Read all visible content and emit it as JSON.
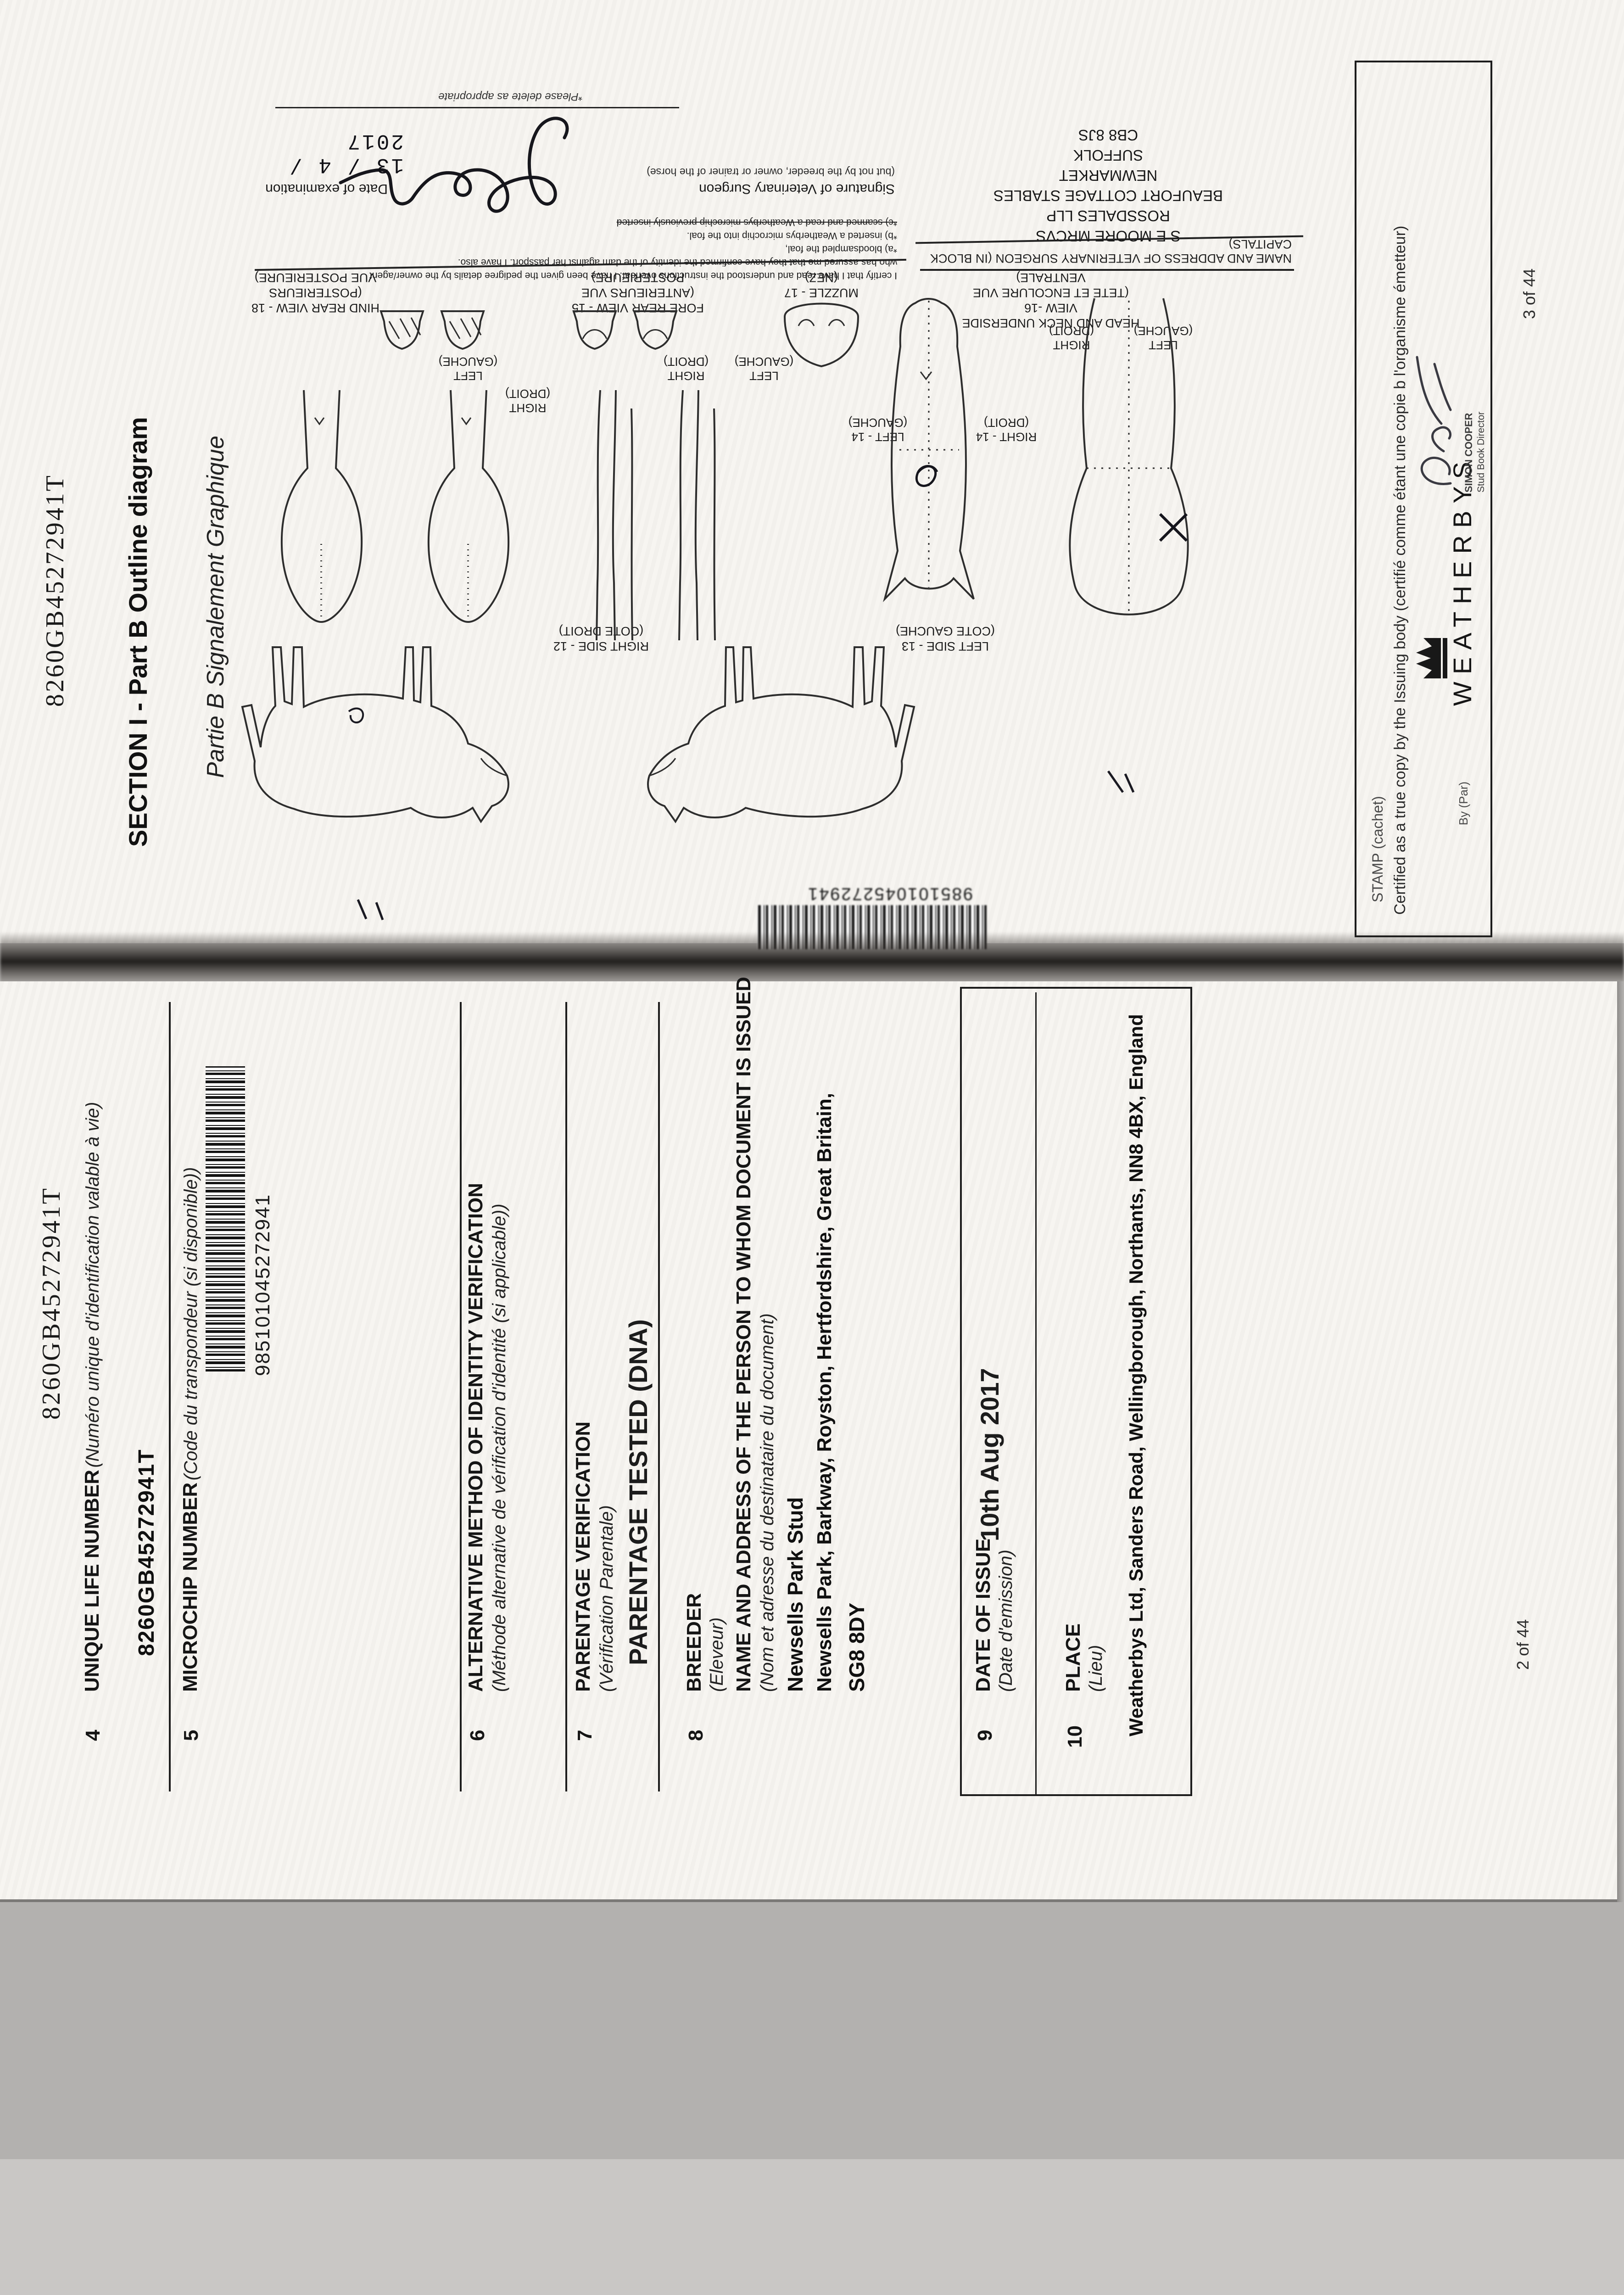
{
  "top_page": {
    "id_number": "8260GB45272941T",
    "section_title": "SECTION I - Part B Outline diagram",
    "section_subtitle": "Partie B Signalement Graphique",
    "certification": {
      "line1": "I certify that I have read and understood the instructions overleaf. I have been given the pedigree details by the owner/agent",
      "line2": "who has assured me that they have confirmed the identity of the dam against her passport. I have also.",
      "item_a": "*a) bloodsampled the foal,",
      "item_b": "*b) inserted a Weatherbys microchip into the foal.",
      "item_c": "*c) scanned and read a Weatherbys microchip previously inserted",
      "signature_label": "Signature of Veterinary Surgeon",
      "signature_note": "(but not by the breeder, owner or trainer of the horse)",
      "delete_note": "*Please delete as appropriate",
      "date_label": "Date of examination",
      "date_value": "13 / 4 / 2017"
    },
    "vet_block": {
      "heading": "NAME AND ADDRESS OF VETERINARY SURGEON (IN BLOCK CAPITALS)",
      "line1": "S E MOORE MRCVS",
      "line2": "ROSSDALES LLP",
      "line3": "BEAUFORT COTTAGE STABLES",
      "line4": "NEWMARKET",
      "line5": "SUFFOLK",
      "line6": "CB8 8JS"
    },
    "diagram_labels": {
      "hind_line1": "HIND REAR VIEW - 18 (POSTERIEURS",
      "hind_line2": "VUE POSTERIEURE)",
      "fore_line1": "FORE REAR VIEW - 15",
      "fore_line2": "(ANTERIEURS VUE POSTERIEURE)",
      "muzzle_line1": "MUZZLE - 17",
      "muzzle_line2": "(NEZ)",
      "head_line1": "HEAD AND NECK UNDERSIDE VIEW -16",
      "head_line2": "(TETE ET ENCOLURE VUE VENTRALE)",
      "right_droit": "RIGHT",
      "right_droit_fr": "(DROIT)",
      "left_gauche": "LEFT",
      "left_gauche_fr": "(GAUCHE)",
      "left14": "LEFT - 14",
      "left14_fr": "(GAUCHE)",
      "right14": "RIGHT - 14",
      "right14_fr": "(DROIT)",
      "right_side_line1": "RIGHT SIDE - 12",
      "right_side_line2": "(COTE DROIT)",
      "left_side_line1": "LEFT SIDE - 13",
      "left_side_line2": "(COTE GAUCHE)"
    },
    "barcode_number": "985101045272941",
    "stamp_box": {
      "label": "STAMP (cachet)",
      "certified_line": "Certified as a true copy by the Issuing body (certifié comme étant une copie b l'organisme émetteur)",
      "by_label": "By (Par)",
      "brand": "WEATHERBYS",
      "signatory_name": "SIMON COOPER",
      "signatory_title": "Stud Book Director"
    },
    "page_number": "3 of 44"
  },
  "bottom_page": {
    "id_number": "8260GB45272941T",
    "fields": [
      {
        "num": "4",
        "label": "UNIQUE LIFE NUMBER",
        "label_fr": "(Numéro unique d'identification valable à vie)",
        "value": "8260GB45272941T"
      },
      {
        "num": "5",
        "label": "MICROCHIP NUMBER",
        "label_fr": "(Code du transpondeur (si disponible))",
        "value": "985101045272941"
      },
      {
        "num": "6",
        "label": "ALTERNATIVE METHOD OF IDENTITY VERIFICATION",
        "label_fr": "(Méthode alternative de vérification d'identité (si applicable))"
      },
      {
        "num": "7",
        "label": "PARENTAGE VERIFICATION",
        "label_fr": "(Vérification Parentale)",
        "value": "PARENTAGE TESTED (DNA)"
      },
      {
        "num": "8",
        "label": "BREEDER",
        "label_fr": "(Eleveur)",
        "label2": "NAME AND ADDRESS OF THE PERSON TO WHOM DOCUMENT IS ISSUED",
        "label2_fr": "(Nom et adresse du destinataire du document)",
        "value_line1": "Newsells Park Stud",
        "value_line2": "Newsells Park, Barkway, Royston, Hertfordshire, Great Britain,",
        "value_line3": "SG8 8DY"
      },
      {
        "num": "9",
        "label": "DATE OF ISSUE",
        "label_fr": "(Date d'emission)",
        "value": "10th Aug 2017"
      },
      {
        "num": "10",
        "label": "PLACE",
        "label_fr": "(Lieu)",
        "value": "Weatherbys Ltd, Sanders Road, Wellingborough, Northants, NN8 4BX, England"
      }
    ],
    "page_number": "2 of 44"
  }
}
